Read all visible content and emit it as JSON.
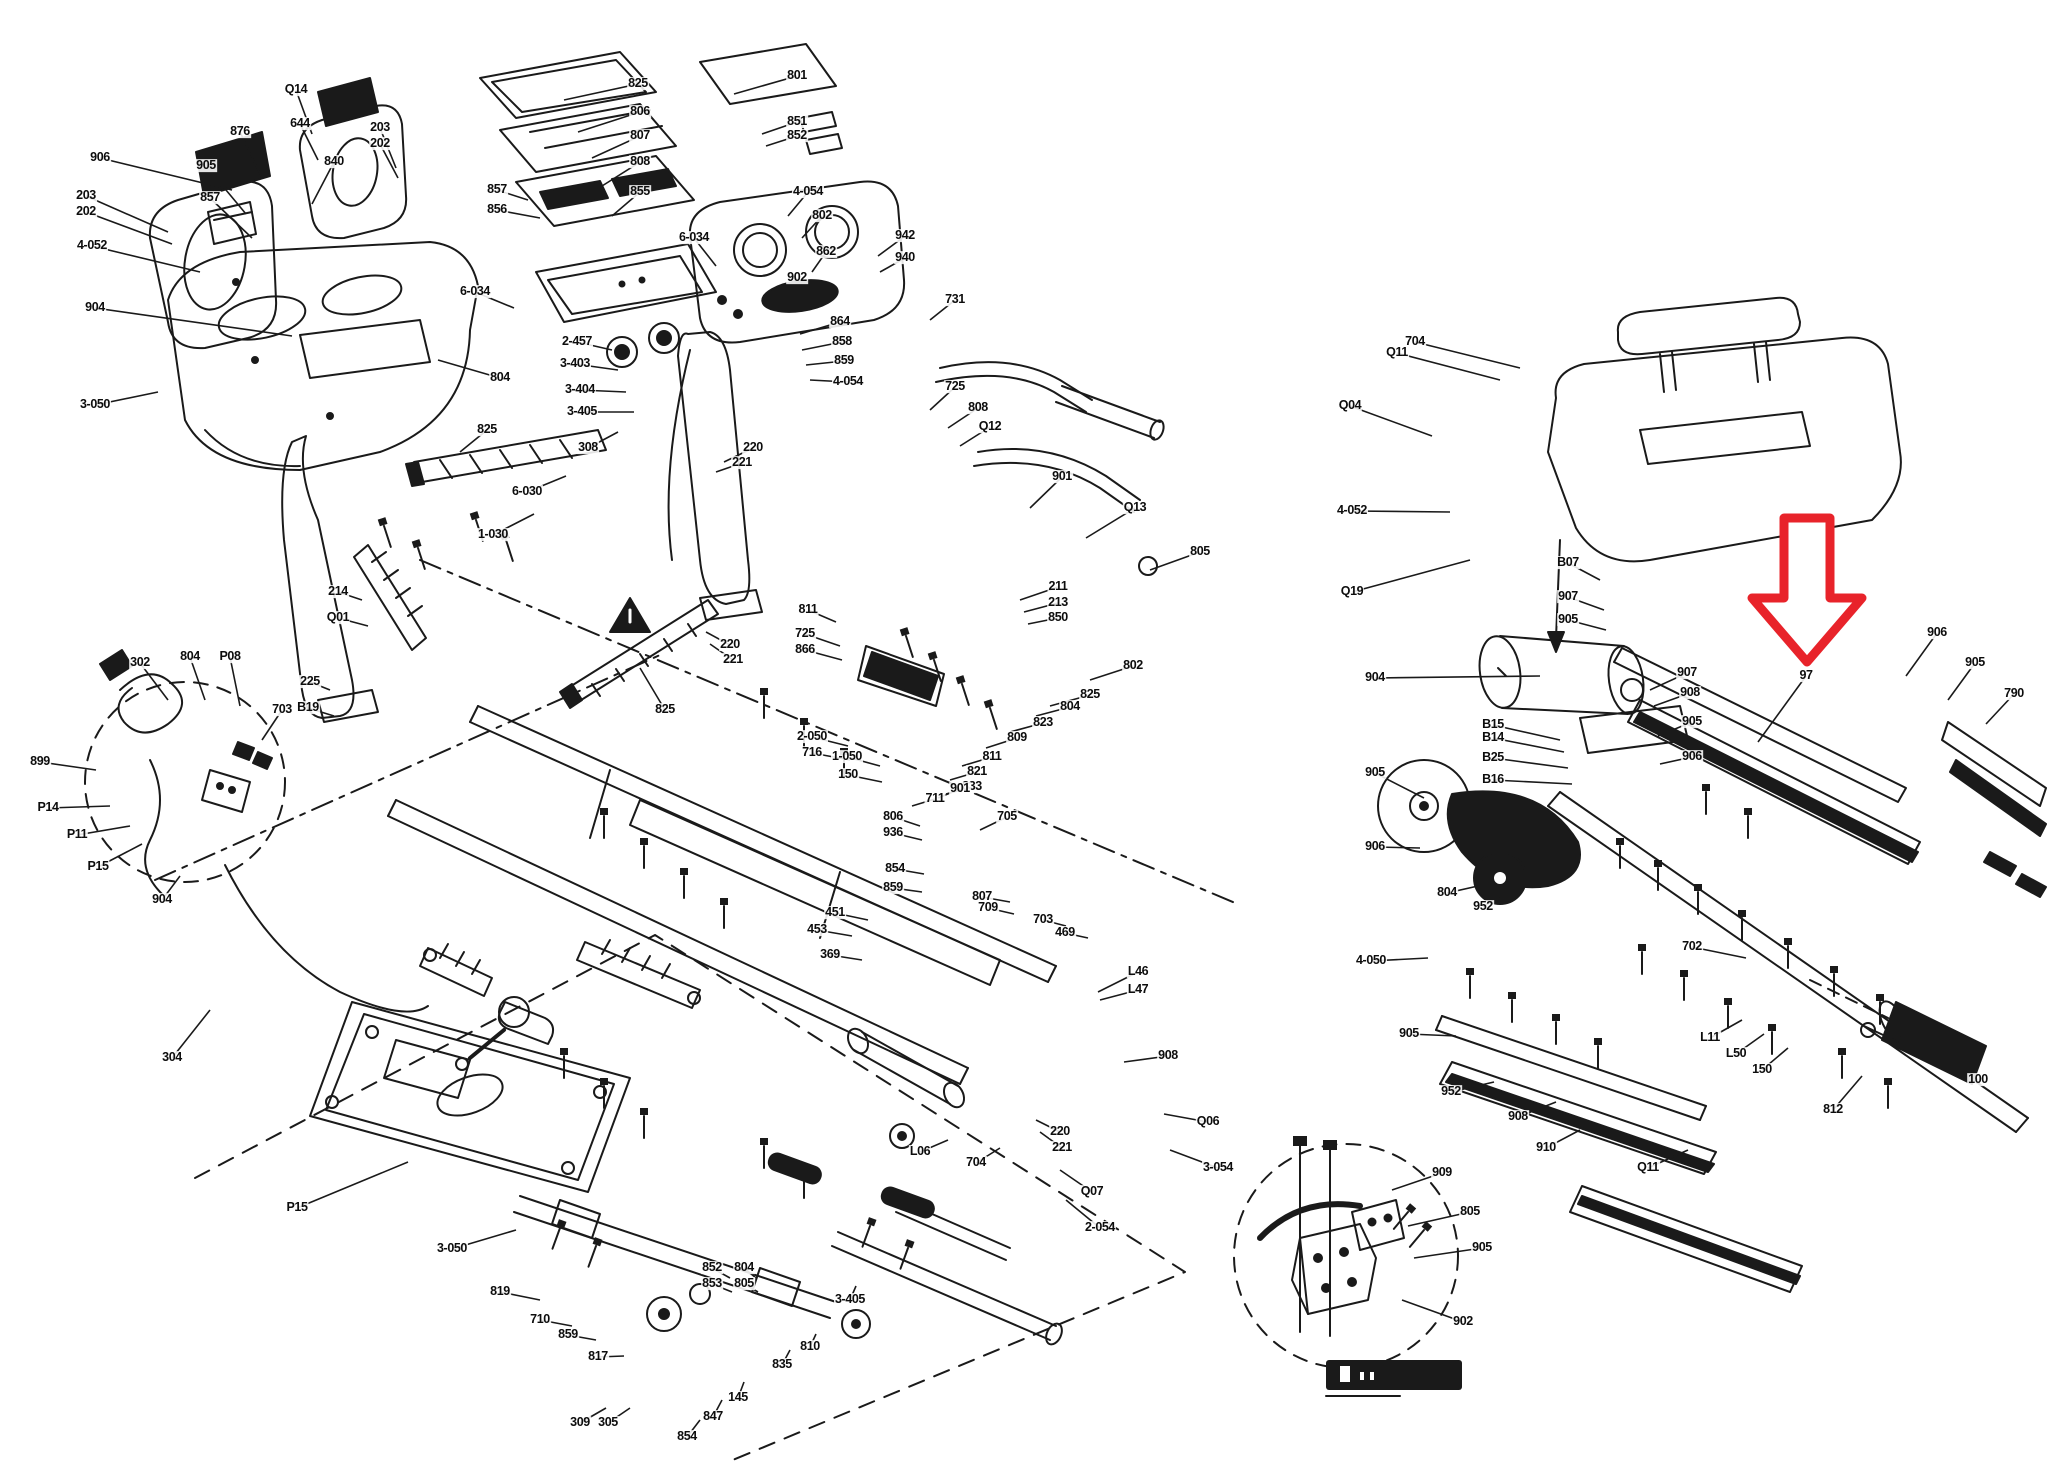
{
  "colors": {
    "ink": "#1a1a1a",
    "arrow": "#e8232a",
    "label": "#0d0d0d",
    "background": "#ffffff"
  },
  "red_arrow": {
    "target_label": "97"
  },
  "labels": [
    {
      "t": "906",
      "x": 100,
      "y": 158,
      "lx": 232,
      "ly": 190
    },
    {
      "t": "203",
      "x": 86,
      "y": 196,
      "lx": 168,
      "ly": 232
    },
    {
      "t": "202",
      "x": 86,
      "y": 212,
      "lx": 172,
      "ly": 244
    },
    {
      "t": "4-052",
      "x": 92,
      "y": 246,
      "lx": 200,
      "ly": 272
    },
    {
      "t": "904",
      "x": 95,
      "y": 308,
      "lx": 292,
      "ly": 336
    },
    {
      "t": "876",
      "x": 240,
      "y": 132,
      "lx": 262,
      "ly": 178
    },
    {
      "t": "905",
      "x": 206,
      "y": 166,
      "lx": 246,
      "ly": 214
    },
    {
      "t": "857",
      "x": 210,
      "y": 198,
      "lx": 252,
      "ly": 238
    },
    {
      "t": "644",
      "x": 300,
      "y": 124,
      "lx": 318,
      "ly": 160
    },
    {
      "t": "840",
      "x": 334,
      "y": 162,
      "lx": 312,
      "ly": 204
    },
    {
      "t": "Q14",
      "x": 296,
      "y": 90,
      "lx": 312,
      "ly": 134
    },
    {
      "t": "203",
      "x": 380,
      "y": 128,
      "lx": 396,
      "ly": 168
    },
    {
      "t": "202",
      "x": 380,
      "y": 144,
      "lx": 398,
      "ly": 178
    },
    {
      "t": "825",
      "x": 638,
      "y": 84,
      "lx": 564,
      "ly": 100
    },
    {
      "t": "806",
      "x": 640,
      "y": 112,
      "lx": 578,
      "ly": 132
    },
    {
      "t": "807",
      "x": 640,
      "y": 136,
      "lx": 592,
      "ly": 158
    },
    {
      "t": "808",
      "x": 640,
      "y": 162,
      "lx": 602,
      "ly": 186
    },
    {
      "t": "855",
      "x": 640,
      "y": 192,
      "lx": 612,
      "ly": 216
    },
    {
      "t": "857",
      "x": 497,
      "y": 190,
      "lx": 528,
      "ly": 200
    },
    {
      "t": "856",
      "x": 497,
      "y": 210,
      "lx": 540,
      "ly": 218
    },
    {
      "t": "801",
      "x": 797,
      "y": 76,
      "lx": 734,
      "ly": 94
    },
    {
      "t": "851",
      "x": 797,
      "y": 122,
      "lx": 762,
      "ly": 134
    },
    {
      "t": "852",
      "x": 797,
      "y": 136,
      "lx": 766,
      "ly": 146
    },
    {
      "t": "4-054",
      "x": 808,
      "y": 192,
      "lx": 788,
      "ly": 216
    },
    {
      "t": "802",
      "x": 822,
      "y": 216,
      "lx": 802,
      "ly": 238
    },
    {
      "t": "862",
      "x": 826,
      "y": 252,
      "lx": 812,
      "ly": 272
    },
    {
      "t": "902",
      "x": 797,
      "y": 278,
      "lx": 778,
      "ly": 296
    },
    {
      "t": "864",
      "x": 840,
      "y": 322,
      "lx": 800,
      "ly": 334
    },
    {
      "t": "858",
      "x": 842,
      "y": 342,
      "lx": 802,
      "ly": 350
    },
    {
      "t": "859",
      "x": 844,
      "y": 361,
      "lx": 806,
      "ly": 365
    },
    {
      "t": "4-054",
      "x": 848,
      "y": 382,
      "lx": 810,
      "ly": 380
    },
    {
      "t": "2-457",
      "x": 577,
      "y": 342,
      "lx": 612,
      "ly": 350
    },
    {
      "t": "3-403",
      "x": 575,
      "y": 364,
      "lx": 618,
      "ly": 370
    },
    {
      "t": "3-404",
      "x": 580,
      "y": 390,
      "lx": 626,
      "ly": 392
    },
    {
      "t": "3-405",
      "x": 582,
      "y": 412,
      "lx": 634,
      "ly": 412
    },
    {
      "t": "6-034",
      "x": 694,
      "y": 238,
      "lx": 716,
      "ly": 266
    },
    {
      "t": "6-034",
      "x": 475,
      "y": 292,
      "lx": 514,
      "ly": 308
    },
    {
      "t": "308",
      "x": 588,
      "y": 448,
      "lx": 618,
      "ly": 432
    },
    {
      "t": "804",
      "x": 500,
      "y": 378,
      "lx": 438,
      "ly": 360
    },
    {
      "t": "3-050",
      "x": 95,
      "y": 405,
      "lx": 158,
      "ly": 392
    },
    {
      "t": "825",
      "x": 487,
      "y": 430,
      "lx": 460,
      "ly": 452
    },
    {
      "t": "6-030",
      "x": 527,
      "y": 492,
      "lx": 566,
      "ly": 476
    },
    {
      "t": "1-030",
      "x": 493,
      "y": 535,
      "lx": 534,
      "ly": 514
    },
    {
      "t": "214",
      "x": 338,
      "y": 592,
      "lx": 362,
      "ly": 600
    },
    {
      "t": "Q01",
      "x": 338,
      "y": 618,
      "lx": 368,
      "ly": 626
    },
    {
      "t": "225",
      "x": 310,
      "y": 682,
      "lx": 330,
      "ly": 690
    },
    {
      "t": "B19",
      "x": 308,
      "y": 708,
      "lx": 334,
      "ly": 716
    },
    {
      "t": "220",
      "x": 753,
      "y": 448,
      "lx": 724,
      "ly": 462
    },
    {
      "t": "221",
      "x": 742,
      "y": 463,
      "lx": 716,
      "ly": 472
    },
    {
      "t": "942",
      "x": 905,
      "y": 236,
      "lx": 878,
      "ly": 256
    },
    {
      "t": "940",
      "x": 905,
      "y": 258,
      "lx": 880,
      "ly": 272
    },
    {
      "t": "731",
      "x": 955,
      "y": 300,
      "lx": 930,
      "ly": 320
    },
    {
      "t": "725",
      "x": 955,
      "y": 387,
      "lx": 930,
      "ly": 410
    },
    {
      "t": "808",
      "x": 978,
      "y": 408,
      "lx": 948,
      "ly": 428
    },
    {
      "t": "Q12",
      "x": 990,
      "y": 427,
      "lx": 960,
      "ly": 446
    },
    {
      "t": "211",
      "x": 1058,
      "y": 587,
      "lx": 1020,
      "ly": 600
    },
    {
      "t": "213",
      "x": 1058,
      "y": 603,
      "lx": 1024,
      "ly": 612
    },
    {
      "t": "850",
      "x": 1058,
      "y": 618,
      "lx": 1028,
      "ly": 624
    },
    {
      "t": "901",
      "x": 1062,
      "y": 477,
      "lx": 1030,
      "ly": 508
    },
    {
      "t": "Q13",
      "x": 1135,
      "y": 508,
      "lx": 1086,
      "ly": 538
    },
    {
      "t": "805",
      "x": 1200,
      "y": 552,
      "lx": 1150,
      "ly": 570
    },
    {
      "t": "811",
      "x": 808,
      "y": 610,
      "lx": 836,
      "ly": 622
    },
    {
      "t": "725",
      "x": 805,
      "y": 634,
      "lx": 840,
      "ly": 646
    },
    {
      "t": "866",
      "x": 805,
      "y": 650,
      "lx": 842,
      "ly": 660
    },
    {
      "t": "220",
      "x": 730,
      "y": 645,
      "lx": 706,
      "ly": 632
    },
    {
      "t": "221",
      "x": 733,
      "y": 660,
      "lx": 710,
      "ly": 644
    },
    {
      "t": "825",
      "x": 665,
      "y": 710,
      "lx": 640,
      "ly": 668
    },
    {
      "t": "802",
      "x": 1133,
      "y": 666,
      "lx": 1090,
      "ly": 680
    },
    {
      "t": "825",
      "x": 1090,
      "y": 695,
      "lx": 1050,
      "ly": 706
    },
    {
      "t": "804",
      "x": 1070,
      "y": 707,
      "lx": 1036,
      "ly": 716
    },
    {
      "t": "823",
      "x": 1043,
      "y": 723,
      "lx": 1010,
      "ly": 732
    },
    {
      "t": "809",
      "x": 1017,
      "y": 738,
      "lx": 986,
      "ly": 748
    },
    {
      "t": "811",
      "x": 992,
      "y": 757,
      "lx": 962,
      "ly": 766
    },
    {
      "t": "821",
      "x": 977,
      "y": 772,
      "lx": 950,
      "ly": 780
    },
    {
      "t": "833",
      "x": 972,
      "y": 787,
      "lx": 946,
      "ly": 794
    },
    {
      "t": "901",
      "x": 960,
      "y": 789,
      "lx": 938,
      "ly": 798
    },
    {
      "t": "711",
      "x": 935,
      "y": 799,
      "lx": 912,
      "ly": 806
    },
    {
      "t": "2-050",
      "x": 812,
      "y": 737,
      "lx": 848,
      "ly": 746
    },
    {
      "t": "716",
      "x": 812,
      "y": 753,
      "lx": 850,
      "ly": 760
    },
    {
      "t": "1-050",
      "x": 847,
      "y": 757,
      "lx": 880,
      "ly": 766
    },
    {
      "t": "150",
      "x": 848,
      "y": 775,
      "lx": 882,
      "ly": 782
    },
    {
      "t": "806",
      "x": 893,
      "y": 817,
      "lx": 920,
      "ly": 826
    },
    {
      "t": "936",
      "x": 893,
      "y": 833,
      "lx": 922,
      "ly": 840
    },
    {
      "t": "854",
      "x": 895,
      "y": 869,
      "lx": 924,
      "ly": 874
    },
    {
      "t": "859",
      "x": 893,
      "y": 888,
      "lx": 922,
      "ly": 892
    },
    {
      "t": "705",
      "x": 1007,
      "y": 817,
      "lx": 980,
      "ly": 830
    },
    {
      "t": "451",
      "x": 835,
      "y": 913,
      "lx": 868,
      "ly": 920
    },
    {
      "t": "453",
      "x": 817,
      "y": 930,
      "lx": 852,
      "ly": 936
    },
    {
      "t": "369",
      "x": 830,
      "y": 955,
      "lx": 862,
      "ly": 960
    },
    {
      "t": "807",
      "x": 982,
      "y": 897,
      "lx": 1010,
      "ly": 902
    },
    {
      "t": "709",
      "x": 988,
      "y": 908,
      "lx": 1014,
      "ly": 914
    },
    {
      "t": "703",
      "x": 1043,
      "y": 920,
      "lx": 1066,
      "ly": 926
    },
    {
      "t": "469",
      "x": 1065,
      "y": 933,
      "lx": 1088,
      "ly": 938
    },
    {
      "t": "L46",
      "x": 1138,
      "y": 972,
      "lx": 1098,
      "ly": 992
    },
    {
      "t": "L47",
      "x": 1138,
      "y": 990,
      "lx": 1100,
      "ly": 1000
    },
    {
      "t": "908",
      "x": 1168,
      "y": 1056,
      "lx": 1124,
      "ly": 1062
    },
    {
      "t": "Q06",
      "x": 1208,
      "y": 1122,
      "lx": 1164,
      "ly": 1114
    },
    {
      "t": "3-054",
      "x": 1218,
      "y": 1168,
      "lx": 1170,
      "ly": 1150
    },
    {
      "t": "Q07",
      "x": 1092,
      "y": 1192,
      "lx": 1060,
      "ly": 1170
    },
    {
      "t": "2-054",
      "x": 1100,
      "y": 1228,
      "lx": 1066,
      "ly": 1200
    },
    {
      "t": "L06",
      "x": 920,
      "y": 1152,
      "lx": 948,
      "ly": 1140
    },
    {
      "t": "704",
      "x": 976,
      "y": 1163,
      "lx": 1000,
      "ly": 1148
    },
    {
      "t": "220",
      "x": 1060,
      "y": 1132,
      "lx": 1036,
      "ly": 1120
    },
    {
      "t": "221",
      "x": 1062,
      "y": 1148,
      "lx": 1040,
      "ly": 1132
    },
    {
      "t": "3-050",
      "x": 452,
      "y": 1249,
      "lx": 516,
      "ly": 1230
    },
    {
      "t": "P15",
      "x": 297,
      "y": 1208,
      "lx": 408,
      "ly": 1162
    },
    {
      "t": "819",
      "x": 500,
      "y": 1292,
      "lx": 540,
      "ly": 1300
    },
    {
      "t": "710",
      "x": 540,
      "y": 1320,
      "lx": 572,
      "ly": 1326
    },
    {
      "t": "859",
      "x": 568,
      "y": 1335,
      "lx": 596,
      "ly": 1340
    },
    {
      "t": "817",
      "x": 598,
      "y": 1357,
      "lx": 624,
      "ly": 1356
    },
    {
      "t": "309",
      "x": 580,
      "y": 1423,
      "lx": 606,
      "ly": 1408
    },
    {
      "t": "305",
      "x": 608,
      "y": 1423,
      "lx": 630,
      "ly": 1408
    },
    {
      "t": "854",
      "x": 687,
      "y": 1437,
      "lx": 700,
      "ly": 1420
    },
    {
      "t": "847",
      "x": 713,
      "y": 1417,
      "lx": 722,
      "ly": 1400
    },
    {
      "t": "145",
      "x": 738,
      "y": 1398,
      "lx": 744,
      "ly": 1382
    },
    {
      "t": "835",
      "x": 782,
      "y": 1365,
      "lx": 790,
      "ly": 1350
    },
    {
      "t": "810",
      "x": 810,
      "y": 1347,
      "lx": 816,
      "ly": 1334
    },
    {
      "t": "3-405",
      "x": 850,
      "y": 1300,
      "lx": 856,
      "ly": 1286
    },
    {
      "t": "852",
      "x": 712,
      "y": 1268,
      "lx": 730,
      "ly": 1278
    },
    {
      "t": "804",
      "x": 744,
      "y": 1268,
      "lx": 756,
      "ly": 1278
    },
    {
      "t": "853",
      "x": 712,
      "y": 1284,
      "lx": 732,
      "ly": 1292
    },
    {
      "t": "805",
      "x": 744,
      "y": 1284,
      "lx": 758,
      "ly": 1292
    },
    {
      "t": "302",
      "x": 140,
      "y": 663,
      "lx": 168,
      "ly": 700
    },
    {
      "t": "804",
      "x": 190,
      "y": 657,
      "lx": 205,
      "ly": 700
    },
    {
      "t": "P08",
      "x": 230,
      "y": 657,
      "lx": 240,
      "ly": 706
    },
    {
      "t": "703",
      "x": 282,
      "y": 710,
      "lx": 262,
      "ly": 740
    },
    {
      "t": "899",
      "x": 40,
      "y": 762,
      "lx": 96,
      "ly": 770
    },
    {
      "t": "P14",
      "x": 48,
      "y": 808,
      "lx": 110,
      "ly": 806
    },
    {
      "t": "P11",
      "x": 77,
      "y": 835,
      "lx": 130,
      "ly": 826
    },
    {
      "t": "P15",
      "x": 98,
      "y": 867,
      "lx": 142,
      "ly": 844
    },
    {
      "t": "904",
      "x": 162,
      "y": 900,
      "lx": 180,
      "ly": 876
    },
    {
      "t": "304",
      "x": 172,
      "y": 1058,
      "lx": 210,
      "ly": 1010
    },
    {
      "t": "704",
      "x": 1415,
      "y": 342,
      "lx": 1520,
      "ly": 368
    },
    {
      "t": "Q11",
      "x": 1397,
      "y": 353,
      "lx": 1500,
      "ly": 380
    },
    {
      "t": "Q04",
      "x": 1350,
      "y": 406,
      "lx": 1432,
      "ly": 436
    },
    {
      "t": "4-052",
      "x": 1352,
      "y": 511,
      "lx": 1450,
      "ly": 512
    },
    {
      "t": "Q19",
      "x": 1352,
      "y": 592,
      "lx": 1470,
      "ly": 560
    },
    {
      "t": "904",
      "x": 1375,
      "y": 678,
      "lx": 1540,
      "ly": 676
    },
    {
      "t": "905",
      "x": 1375,
      "y": 773,
      "lx": 1424,
      "ly": 798
    },
    {
      "t": "906",
      "x": 1375,
      "y": 847,
      "lx": 1420,
      "ly": 848
    },
    {
      "t": "B15",
      "x": 1493,
      "y": 725,
      "lx": 1560,
      "ly": 740
    },
    {
      "t": "B14",
      "x": 1493,
      "y": 738,
      "lx": 1564,
      "ly": 752
    },
    {
      "t": "B25",
      "x": 1493,
      "y": 758,
      "lx": 1568,
      "ly": 768
    },
    {
      "t": "B16",
      "x": 1493,
      "y": 780,
      "lx": 1572,
      "ly": 784
    },
    {
      "t": "804",
      "x": 1447,
      "y": 893,
      "lx": 1478,
      "ly": 886
    },
    {
      "t": "952",
      "x": 1483,
      "y": 907,
      "lx": 1504,
      "ly": 894
    },
    {
      "t": "907",
      "x": 1687,
      "y": 673,
      "lx": 1650,
      "ly": 690
    },
    {
      "t": "908",
      "x": 1690,
      "y": 693,
      "lx": 1654,
      "ly": 706
    },
    {
      "t": "905",
      "x": 1692,
      "y": 722,
      "lx": 1658,
      "ly": 736
    },
    {
      "t": "906",
      "x": 1692,
      "y": 757,
      "lx": 1660,
      "ly": 764
    },
    {
      "t": "B07",
      "x": 1568,
      "y": 563,
      "lx": 1600,
      "ly": 580
    },
    {
      "t": "907",
      "x": 1568,
      "y": 597,
      "lx": 1604,
      "ly": 610
    },
    {
      "t": "905",
      "x": 1568,
      "y": 620,
      "lx": 1606,
      "ly": 630
    },
    {
      "t": "97",
      "x": 1806,
      "y": 676,
      "lx": 1758,
      "ly": 742
    },
    {
      "t": "906",
      "x": 1937,
      "y": 633,
      "lx": 1906,
      "ly": 676
    },
    {
      "t": "905",
      "x": 1975,
      "y": 663,
      "lx": 1948,
      "ly": 700
    },
    {
      "t": "790",
      "x": 2014,
      "y": 694,
      "lx": 1986,
      "ly": 724
    },
    {
      "t": "702",
      "x": 1692,
      "y": 947,
      "lx": 1746,
      "ly": 958
    },
    {
      "t": "4-050",
      "x": 1371,
      "y": 961,
      "lx": 1428,
      "ly": 958
    },
    {
      "t": "905",
      "x": 1409,
      "y": 1034,
      "lx": 1456,
      "ly": 1036
    },
    {
      "t": "952",
      "x": 1451,
      "y": 1092,
      "lx": 1494,
      "ly": 1082
    },
    {
      "t": "908",
      "x": 1518,
      "y": 1117,
      "lx": 1556,
      "ly": 1102
    },
    {
      "t": "910",
      "x": 1546,
      "y": 1148,
      "lx": 1580,
      "ly": 1130
    },
    {
      "t": "Q11",
      "x": 1648,
      "y": 1168,
      "lx": 1688,
      "ly": 1150
    },
    {
      "t": "L11",
      "x": 1710,
      "y": 1038,
      "lx": 1742,
      "ly": 1020
    },
    {
      "t": "L50",
      "x": 1736,
      "y": 1054,
      "lx": 1764,
      "ly": 1034
    },
    {
      "t": "150",
      "x": 1762,
      "y": 1070,
      "lx": 1788,
      "ly": 1048
    },
    {
      "t": "812",
      "x": 1833,
      "y": 1110,
      "lx": 1862,
      "ly": 1076
    },
    {
      "t": "100",
      "x": 1978,
      "y": 1080,
      "lx": 1944,
      "ly": 1052
    },
    {
      "t": "909",
      "x": 1442,
      "y": 1173,
      "lx": 1392,
      "ly": 1190
    },
    {
      "t": "805",
      "x": 1470,
      "y": 1212,
      "lx": 1408,
      "ly": 1226
    },
    {
      "t": "905",
      "x": 1482,
      "y": 1248,
      "lx": 1414,
      "ly": 1258
    },
    {
      "t": "902",
      "x": 1463,
      "y": 1322,
      "lx": 1402,
      "ly": 1300
    }
  ]
}
